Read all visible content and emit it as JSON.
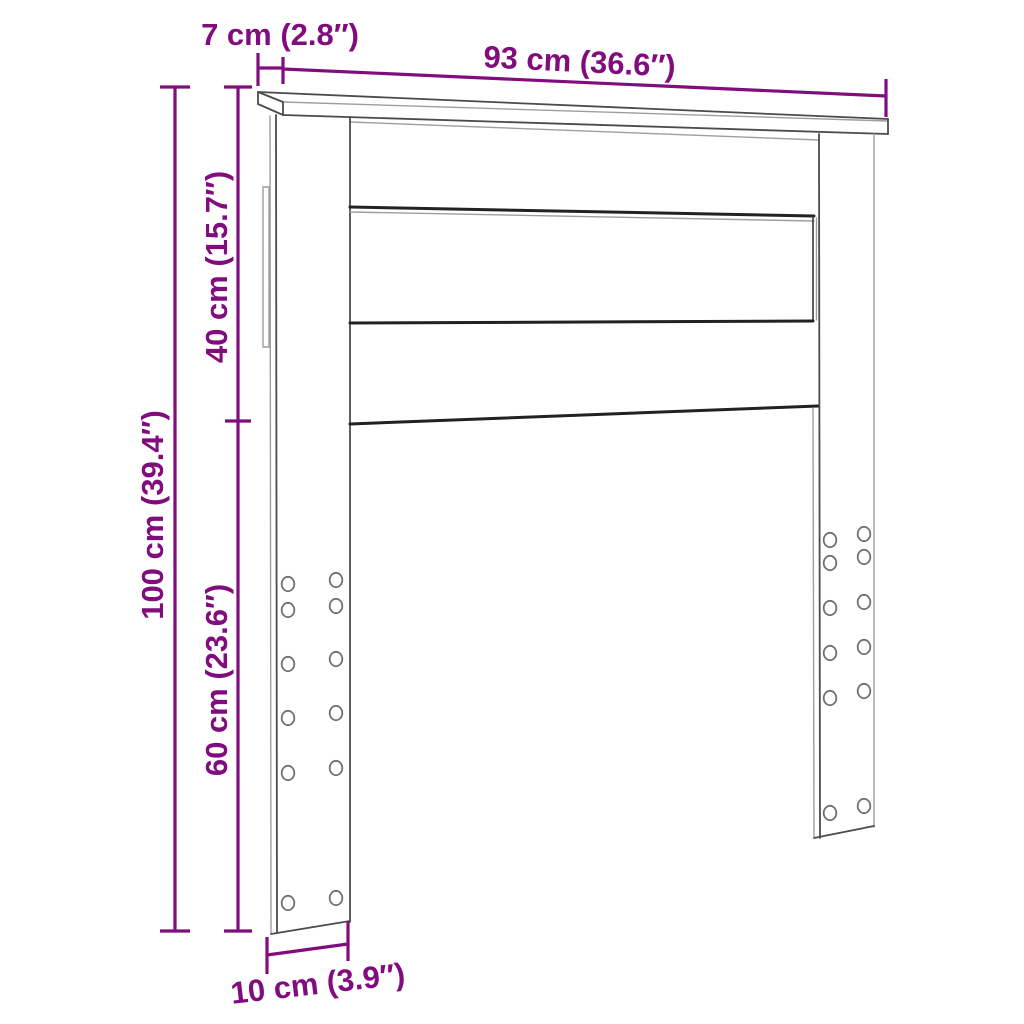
{
  "page": {
    "background": "#ffffff",
    "description_labels_language": "metric + imperial"
  },
  "colors": {
    "accent": "#810c7e",
    "line-dark": "#222222",
    "line-mid": "#4b4b4b",
    "line-light": "#9e9e9e",
    "hole": "#707070",
    "bg": "#ffffff"
  },
  "diagram": {
    "dimensions": {
      "top_depth": "7 cm (2.8″)",
      "width": "93 cm (36.6″)",
      "upper_panel_height": "40 cm (15.7″)",
      "total_height": "100 cm (39.4″)",
      "leg_height": "60 cm (23.6″)",
      "leg_width": "10 cm (3.9″)"
    }
  }
}
